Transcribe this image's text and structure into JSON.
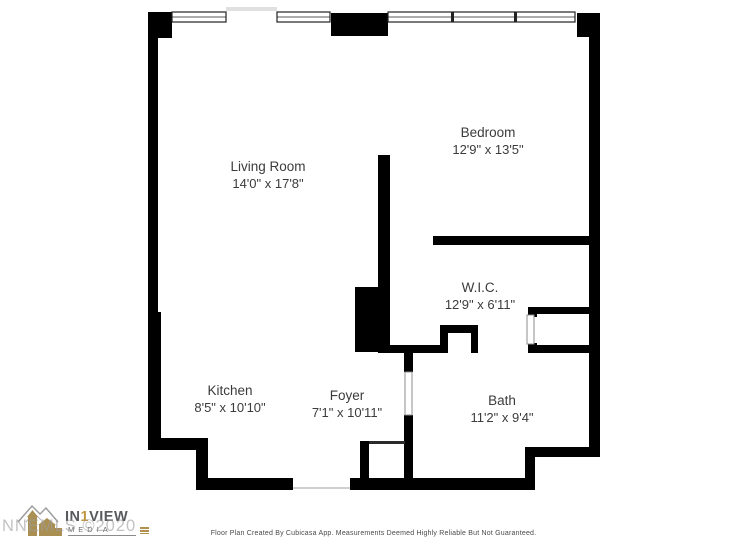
{
  "rooms": {
    "living_room": {
      "name": "Living Room",
      "dims": "14'0\" x 17'8\""
    },
    "bedroom": {
      "name": "Bedroom",
      "dims": "12'9\" x 13'5\""
    },
    "wic": {
      "name": "W.I.C.",
      "dims": "12'9\" x 6'11\""
    },
    "kitchen": {
      "name": "Kitchen",
      "dims": "8'5\" x 10'10\""
    },
    "foyer": {
      "name": "Foyer",
      "dims": "7'1\" x 10'11\""
    },
    "bath": {
      "name": "Bath",
      "dims": "11'2\" x 9'4\""
    }
  },
  "branding": {
    "logo_in": "IN",
    "logo_one": "1",
    "logo_view": "VIEW",
    "logo_subtitle": "MEDIA",
    "watermark": "NNEMLS ©2020"
  },
  "footer": {
    "disclaimer": "Floor Plan Created By Cubicasa App. Measurements Deemed Highly Reliable But Not Guaranteed."
  },
  "colors": {
    "wall": "#000000",
    "label_text": "#3b3b3b",
    "gold": "#b1924f",
    "watermark_grey": "#9d9d9d",
    "window_outline": "#222222"
  }
}
